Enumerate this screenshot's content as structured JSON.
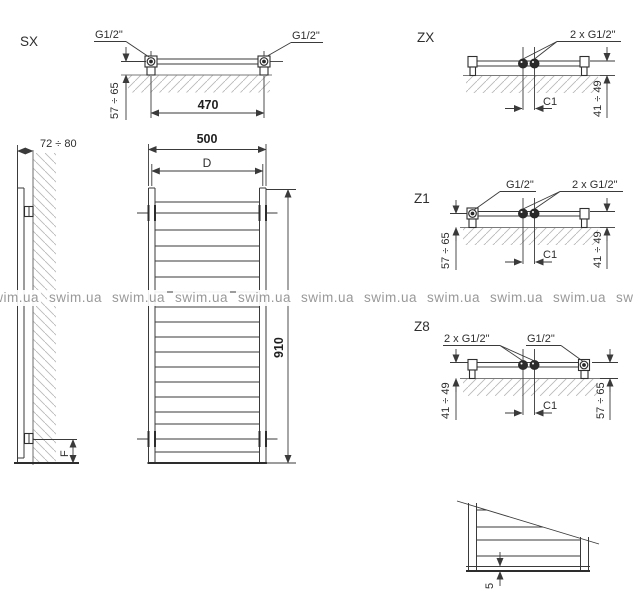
{
  "watermark": {
    "text": "swim.ua",
    "count": 11,
    "start_x": -16,
    "step_x": 63,
    "color": "#999999"
  },
  "colors": {
    "line": "#3a3a3a",
    "wall": "#7a7a7a",
    "hatch": "#b9b9b9",
    "text": "#2e2e2e",
    "watermark": "#999999"
  },
  "views": {
    "sx": {
      "label": "SX",
      "conn_left": "G1/2\"",
      "conn_right": "G1/2\"",
      "dim_wall_offset": "57 ÷ 65",
      "dim_conn_spacing": "470"
    },
    "side": {
      "dim_depth": "72 ÷ 80",
      "dim_floor_offset": "F"
    },
    "front": {
      "dim_width": "500",
      "dim_axis_spacing": "D",
      "dim_height": "910",
      "rung_ys": [
        202,
        213,
        230,
        246,
        261,
        277,
        292,
        307,
        322,
        337,
        352,
        367,
        382,
        397,
        412,
        424,
        439,
        452
      ]
    },
    "zx": {
      "label": "ZX",
      "conn_center": "2 x G1/2\"",
      "dim_wall_offset_right": "41 ÷ 49",
      "dim_center_spacing": "C1"
    },
    "z1": {
      "label": "Z1",
      "conn_left": "G1/2\"",
      "conn_center": "2 x G1/2\"",
      "dim_wall_offset_left": "57 ÷ 65",
      "dim_center_spacing": "C1",
      "dim_wall_offset_right": "41 ÷ 49"
    },
    "z8": {
      "label": "Z8",
      "conn_center": "2 x G1/2\"",
      "conn_right": "G1/2\"",
      "dim_wall_offset_left": "41 ÷ 49",
      "dim_center_spacing": "C1",
      "dim_wall_offset_right": "57 ÷ 65"
    },
    "bottom_detail": {
      "dim_bottom_gap": "5"
    }
  }
}
